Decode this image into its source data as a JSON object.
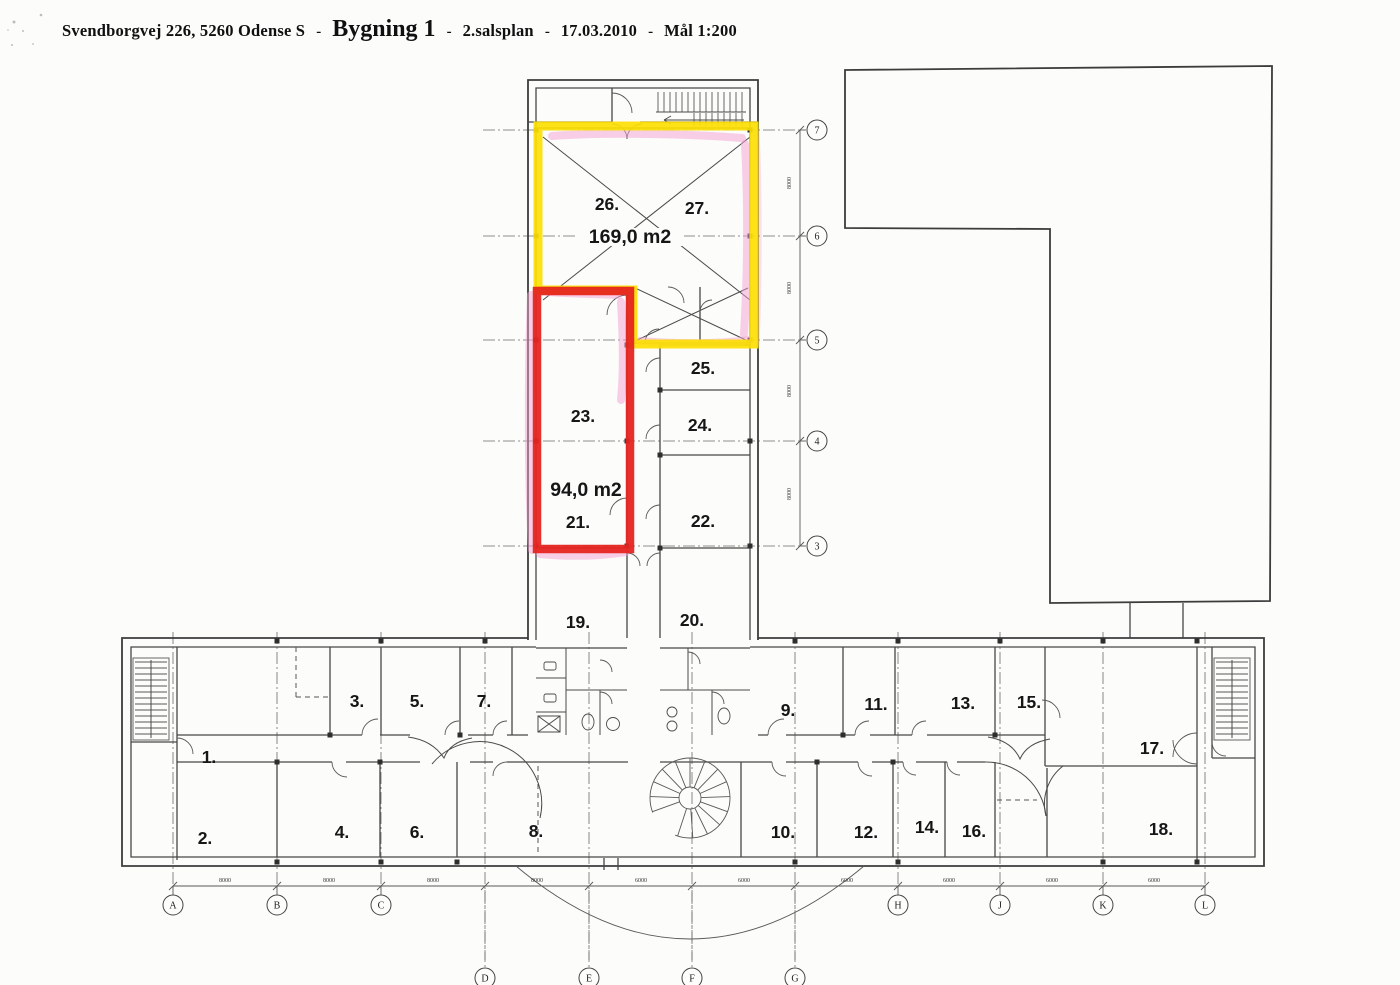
{
  "header": {
    "address": "Svendborgvej 226,  5260 Odense S",
    "sep": "-",
    "building": "Bygning 1",
    "floor": "2.salsplan",
    "date": "17.03.2010",
    "scale": "Mål 1:200"
  },
  "plan": {
    "highlight_zones": [
      {
        "name": "yellow-zone",
        "rooms": [
          "26.",
          "27."
        ],
        "area_label": "169,0 m2",
        "color": "#fddf04"
      },
      {
        "name": "red-zone",
        "rooms": [
          "23.",
          "21."
        ],
        "area_label": "94,0 m2",
        "color": "#e62520"
      }
    ],
    "marker_color_pink": "#f2a0d2",
    "rooms": [
      {
        "label": "1.",
        "x": 209,
        "y": 763
      },
      {
        "label": "2.",
        "x": 205,
        "y": 844
      },
      {
        "label": "3.",
        "x": 357,
        "y": 707
      },
      {
        "label": "4.",
        "x": 342,
        "y": 838
      },
      {
        "label": "5.",
        "x": 417,
        "y": 707
      },
      {
        "label": "6.",
        "x": 417,
        "y": 838
      },
      {
        "label": "7.",
        "x": 484,
        "y": 707
      },
      {
        "label": "8.",
        "x": 536,
        "y": 837
      },
      {
        "label": "9.",
        "x": 788,
        "y": 716
      },
      {
        "label": "10.",
        "x": 783,
        "y": 838
      },
      {
        "label": "11.",
        "x": 876,
        "y": 710
      },
      {
        "label": "12.",
        "x": 866,
        "y": 838
      },
      {
        "label": "13.",
        "x": 963,
        "y": 709
      },
      {
        "label": "14.",
        "x": 927,
        "y": 833
      },
      {
        "label": "15.",
        "x": 1029,
        "y": 708
      },
      {
        "label": "16.",
        "x": 974,
        "y": 837
      },
      {
        "label": "17.",
        "x": 1152,
        "y": 754
      },
      {
        "label": "18.",
        "x": 1161,
        "y": 835
      },
      {
        "label": "19.",
        "x": 578,
        "y": 628
      },
      {
        "label": "20.",
        "x": 692,
        "y": 626
      },
      {
        "label": "21.",
        "x": 578,
        "y": 528
      },
      {
        "label": "22.",
        "x": 703,
        "y": 527
      },
      {
        "label": "23.",
        "x": 583,
        "y": 422
      },
      {
        "label": "24.",
        "x": 700,
        "y": 431
      },
      {
        "label": "25.",
        "x": 703,
        "y": 374
      },
      {
        "label": "26.",
        "x": 607,
        "y": 210
      },
      {
        "label": "27.",
        "x": 697,
        "y": 214
      }
    ],
    "area_labels": [
      {
        "text": "169,0 m2",
        "x": 630,
        "y": 243
      },
      {
        "text": "94,0 m2",
        "x": 586,
        "y": 496
      }
    ],
    "grid": {
      "right_axis": {
        "bubbles": [
          {
            "label": "7",
            "y": 130
          },
          {
            "label": "6",
            "y": 236
          },
          {
            "label": "5",
            "y": 340
          },
          {
            "label": "4",
            "y": 441
          },
          {
            "label": "3",
            "y": 546
          }
        ],
        "dims": [
          {
            "text": "8000",
            "y": 183
          },
          {
            "text": "8000",
            "y": 288
          },
          {
            "text": "8000",
            "y": 391
          },
          {
            "text": "8000",
            "y": 494
          }
        ]
      },
      "bottom_axis": {
        "bubbles": [
          {
            "label": "A",
            "x": 173,
            "y": 905
          },
          {
            "label": "B",
            "x": 277,
            "y": 905
          },
          {
            "label": "C",
            "x": 381,
            "y": 905
          },
          {
            "label": "D",
            "x": 485,
            "y": 978
          },
          {
            "label": "E",
            "x": 589,
            "y": 978
          },
          {
            "label": "F",
            "x": 692,
            "y": 978
          },
          {
            "label": "G",
            "x": 795,
            "y": 978
          },
          {
            "label": "H",
            "x": 898,
            "y": 905
          },
          {
            "label": "J",
            "x": 1000,
            "y": 905
          },
          {
            "label": "K",
            "x": 1103,
            "y": 905
          },
          {
            "label": "L",
            "x": 1205,
            "y": 905
          }
        ],
        "dims": [
          {
            "text": "8000",
            "x": 225
          },
          {
            "text": "8000",
            "x": 329
          },
          {
            "text": "8000",
            "x": 433
          },
          {
            "text": "8000",
            "x": 537
          },
          {
            "text": "6000",
            "x": 641
          },
          {
            "text": "6000",
            "x": 744
          },
          {
            "text": "6000",
            "x": 847
          },
          {
            "text": "6000",
            "x": 949
          },
          {
            "text": "6000",
            "x": 1052
          },
          {
            "text": "6000",
            "x": 1154
          }
        ]
      }
    }
  }
}
